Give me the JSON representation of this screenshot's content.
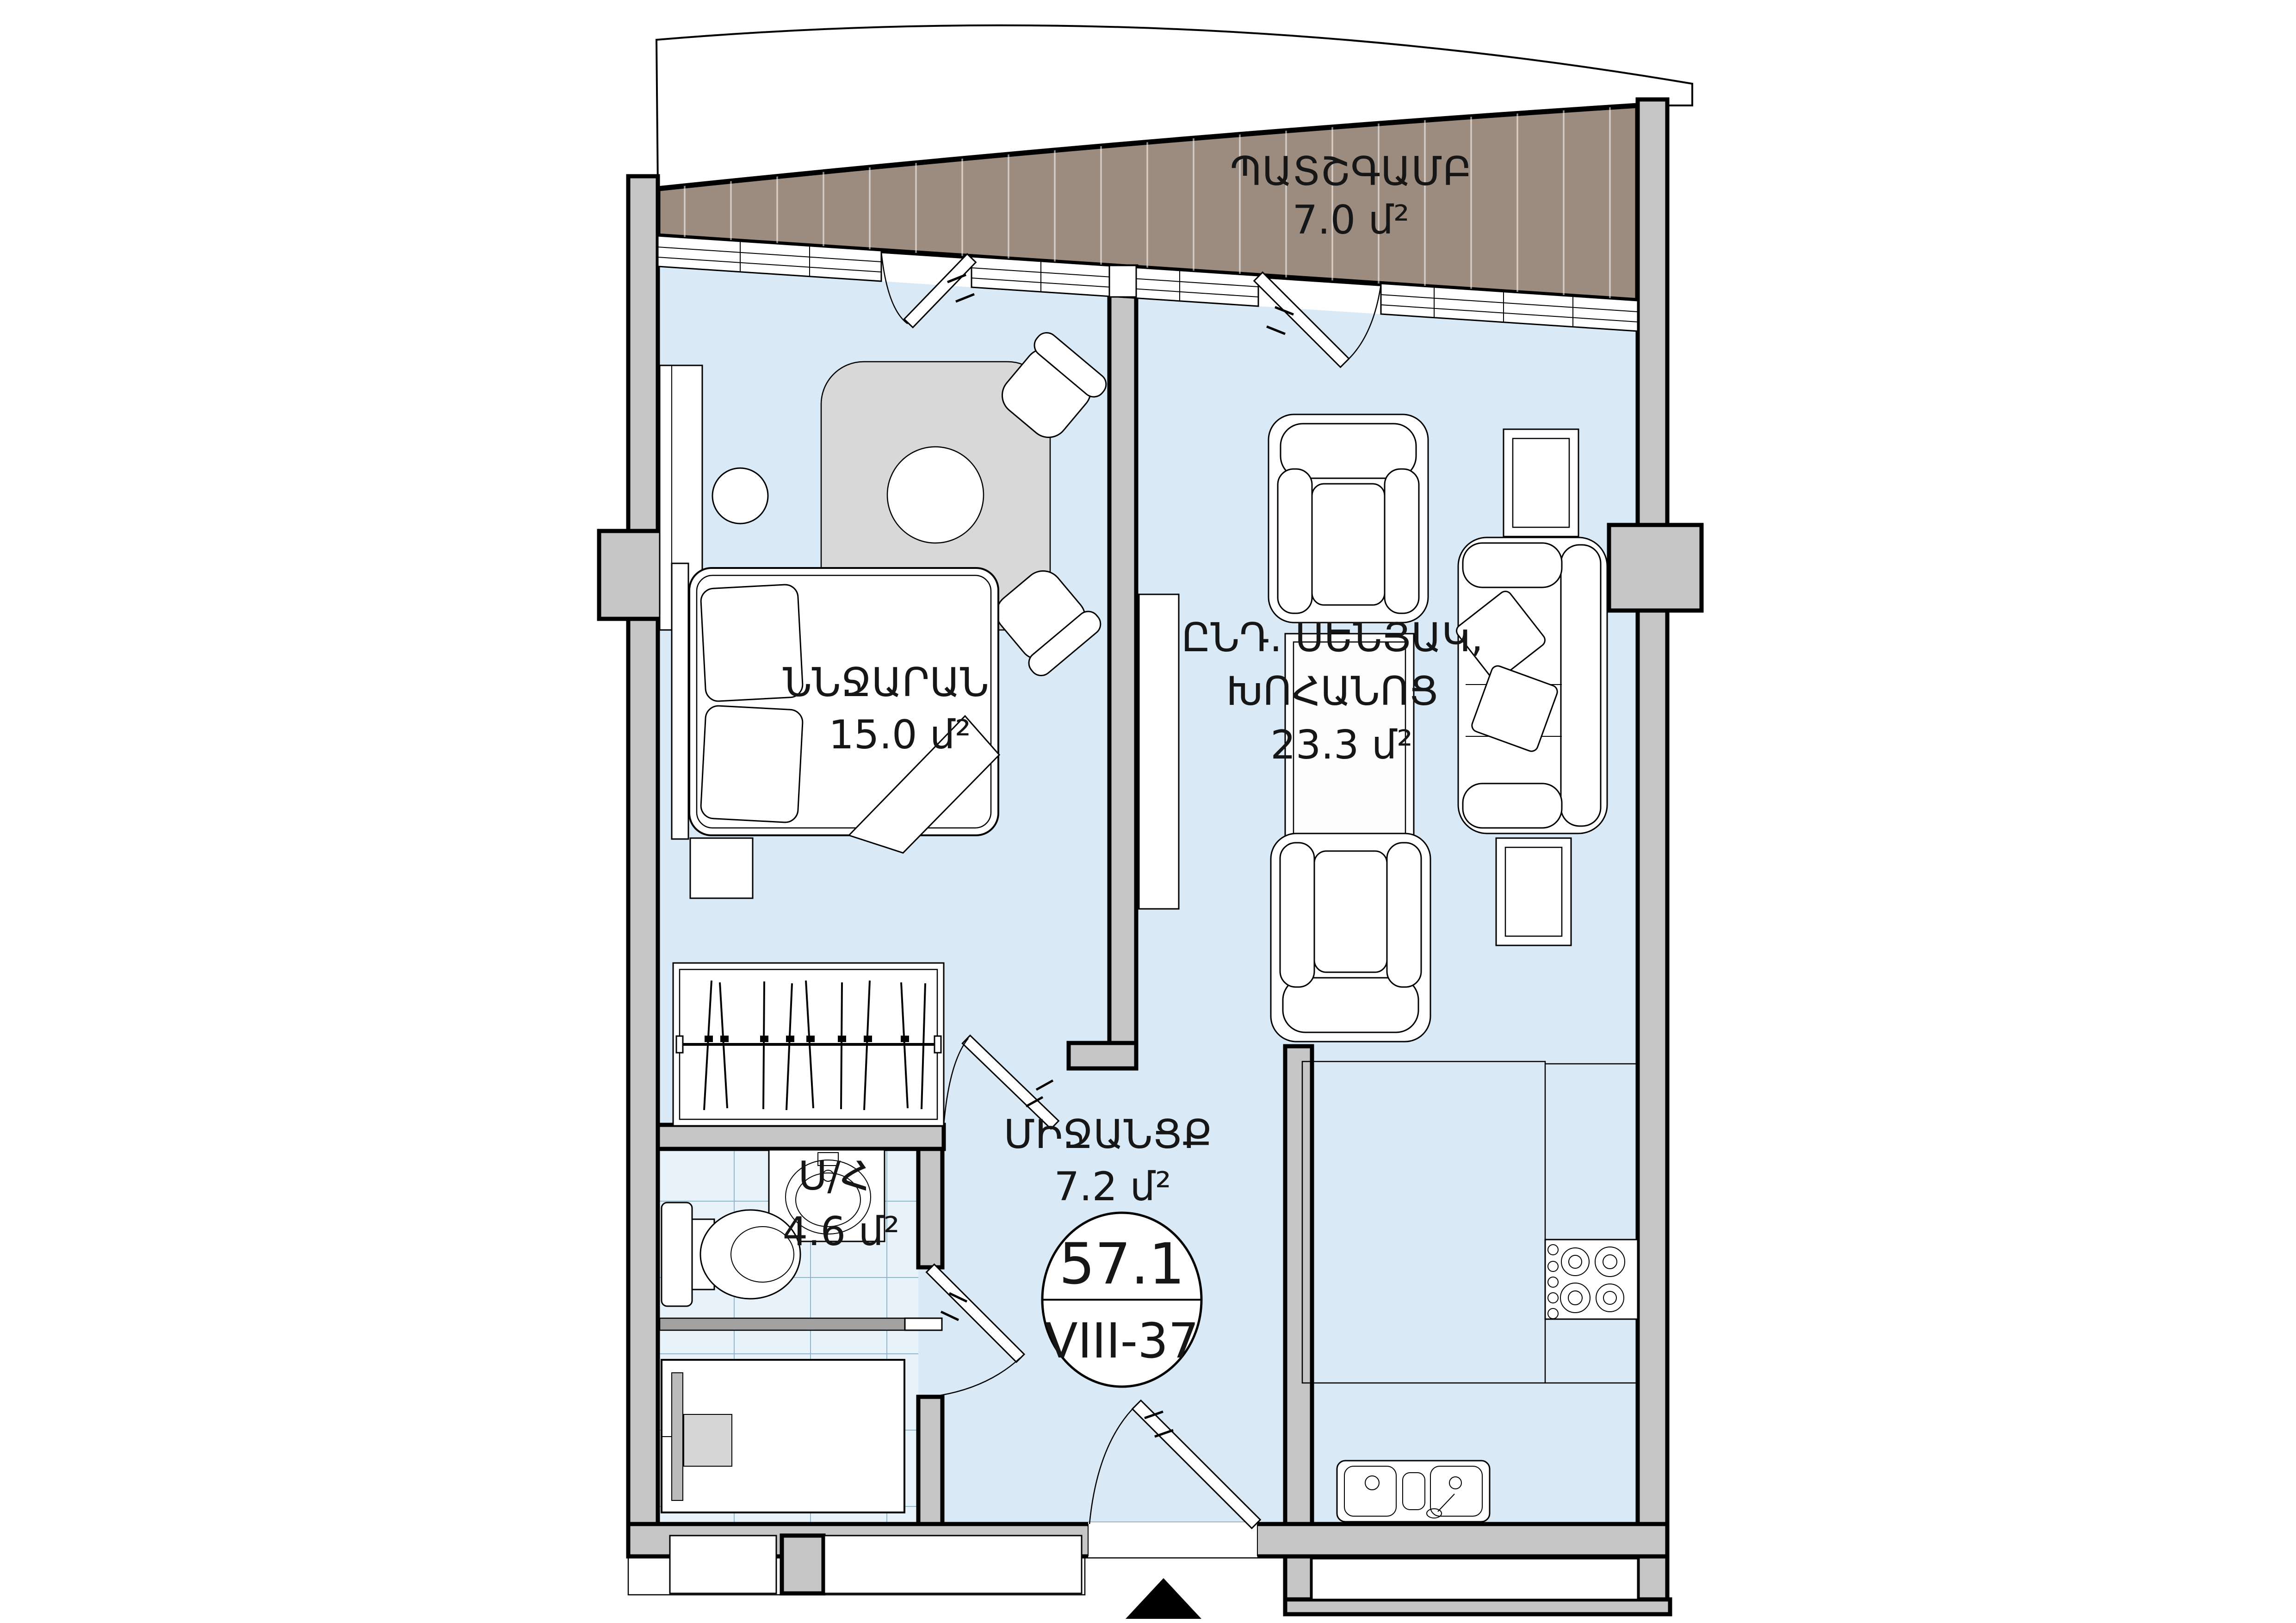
{
  "colors": {
    "floor": "#d9eaf6",
    "tile_floor": "#e7f2fa",
    "balcony_deck": "#9c8c80",
    "wall": "#c6c6c6",
    "line": "#000000",
    "label": "#161616",
    "furniture_fill": "#ffffff",
    "table_fill": "#d8d8d8"
  },
  "rooms": {
    "balcony": {
      "label": "ՊԱՏՇԳԱՄԲ",
      "area": "7.0 մ²"
    },
    "bedroom": {
      "label": "ՆՆՋԱՐԱՆ",
      "area": "15.0 մ²"
    },
    "living": {
      "label_line1": "ԸՆԴ. ՍԵՆՅԱԿ,",
      "label_line2": "ԽՈՀԱՆՈՑ",
      "area": "23.3 մ²"
    },
    "hallway": {
      "label": "ՄԻՋԱՆՑՔ",
      "area": "7.2 մ²"
    },
    "bathroom": {
      "label": "Ս/Հ",
      "area": "4.6 մ²"
    }
  },
  "badge": {
    "total_area": "57.1",
    "unit": "VIII-37"
  }
}
